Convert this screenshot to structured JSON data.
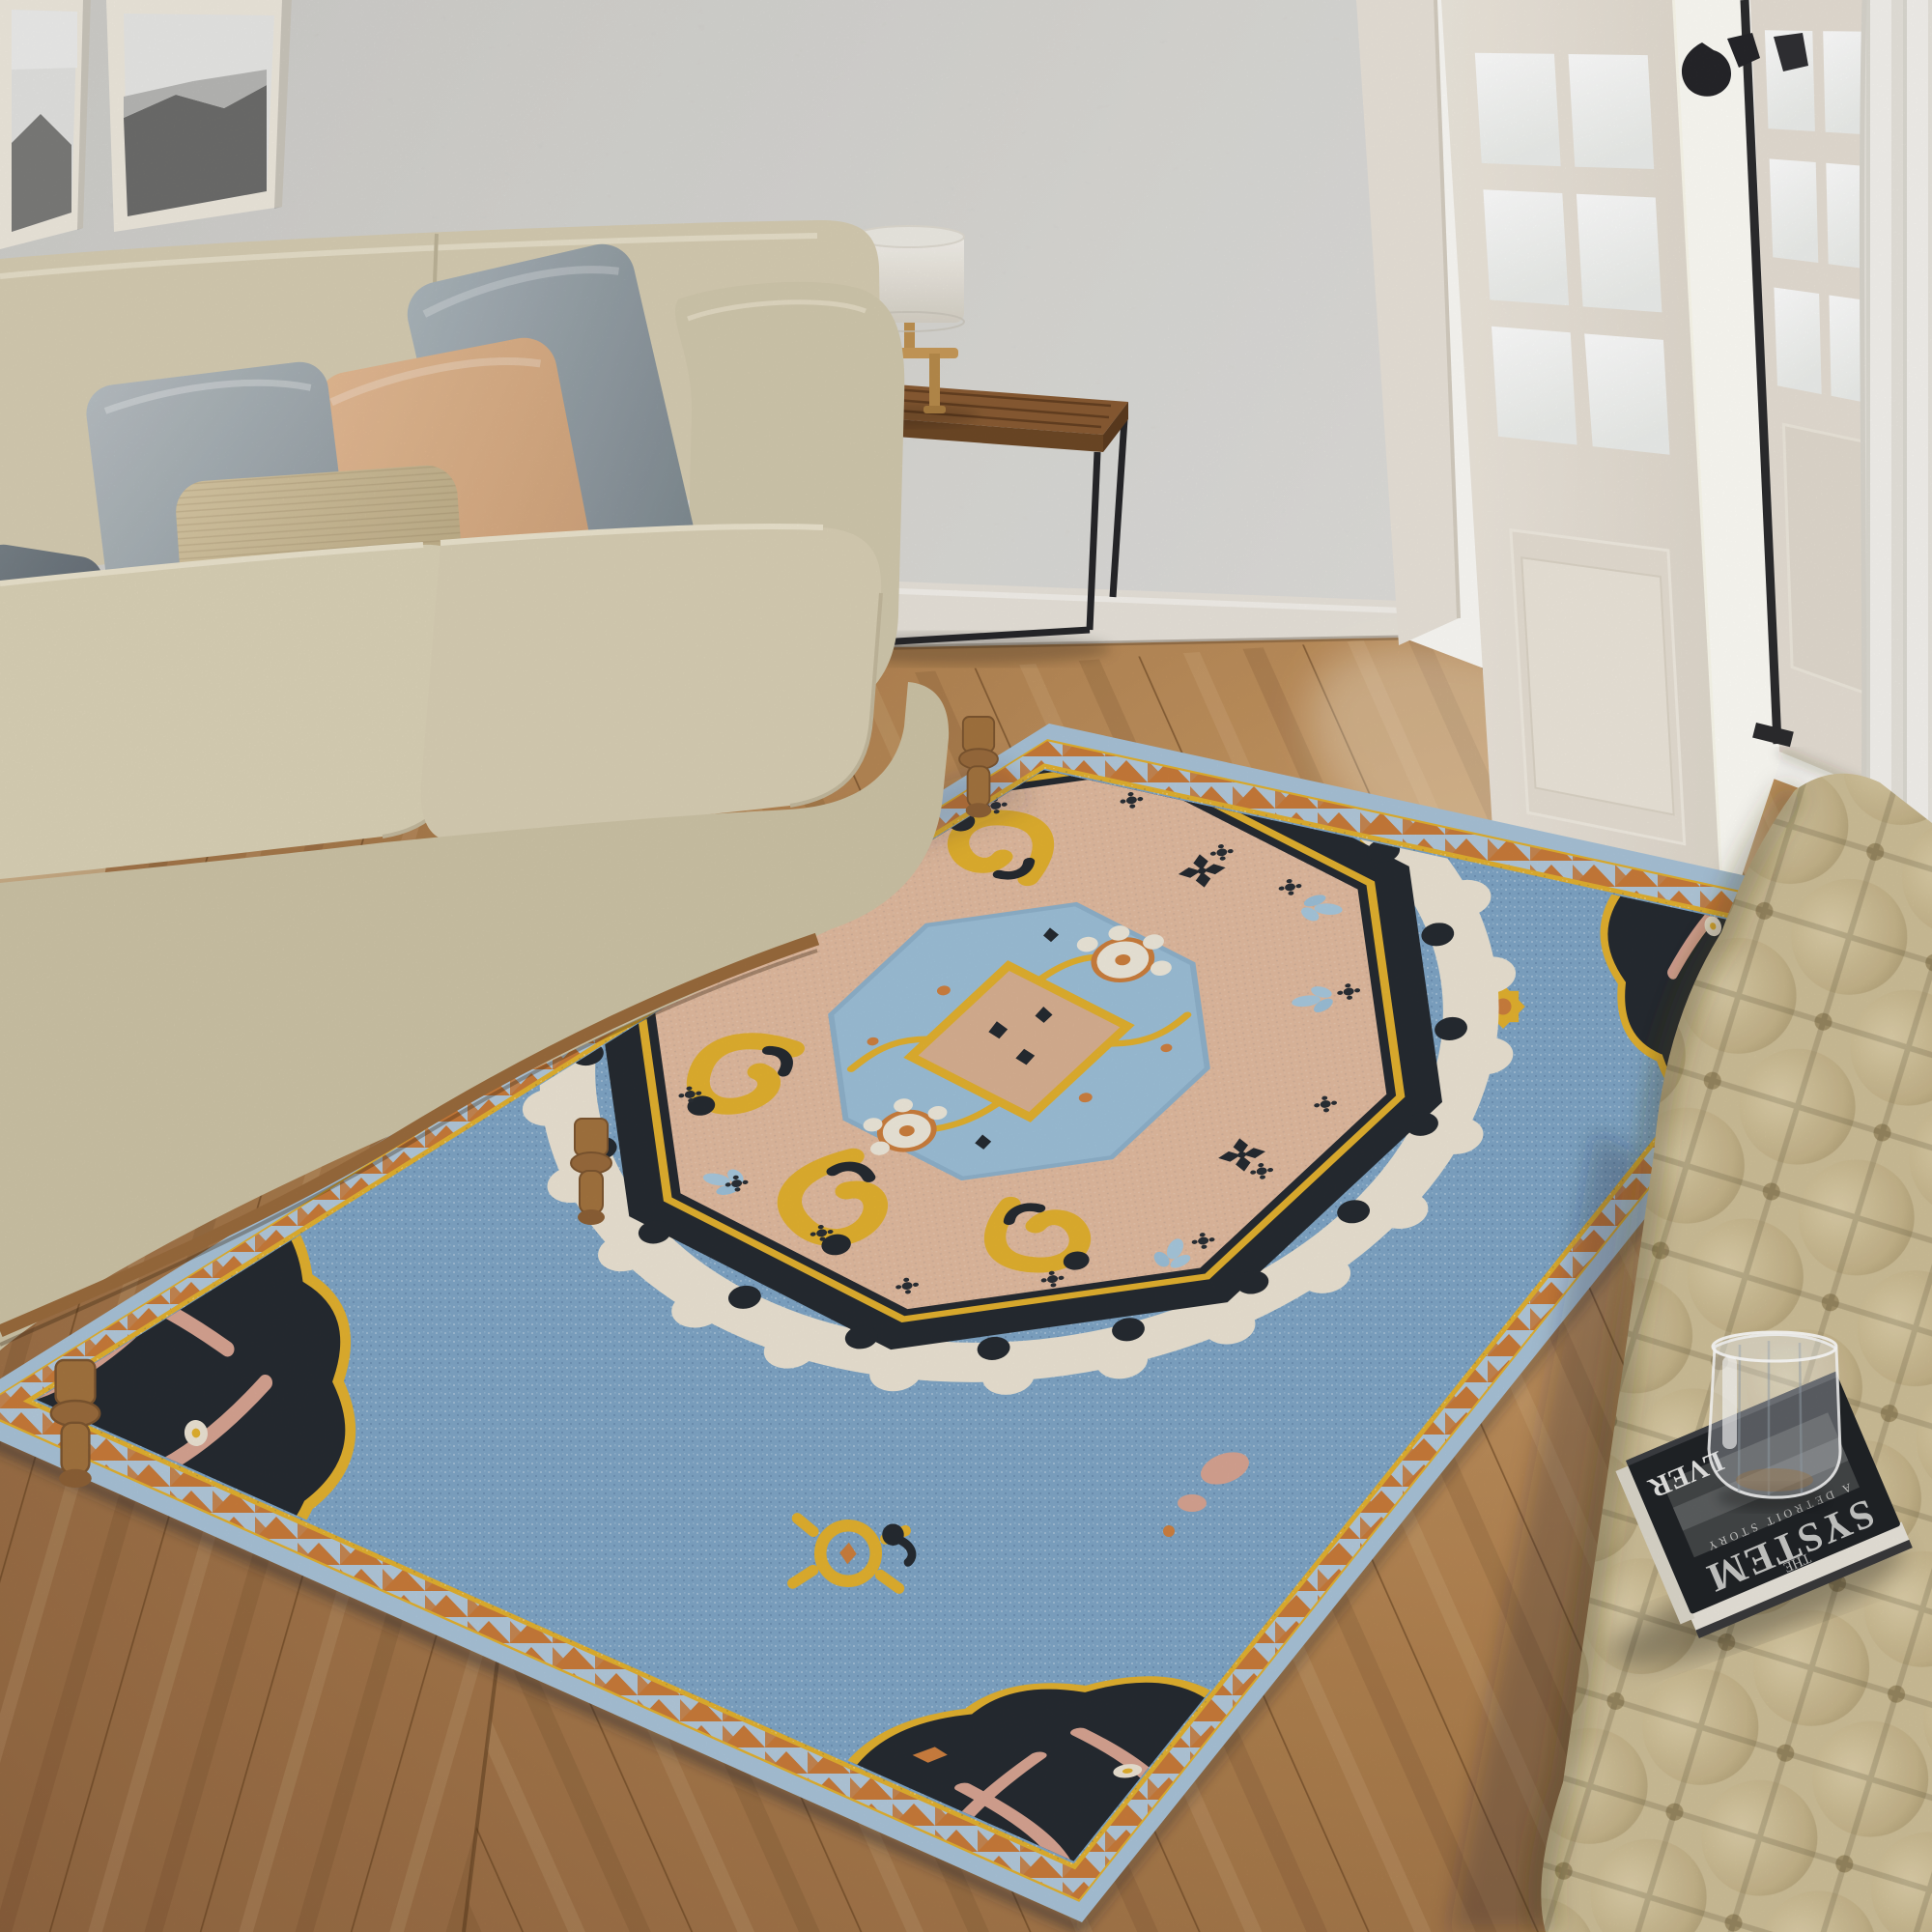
{
  "scene": {
    "description": "3D interior render: living room with cream sofa, blue oriental medallion rug, wood chevron floor, open french doors, tufted ottoman, book with glass tumbler",
    "book": {
      "pretitle": "THE",
      "title": "SYSTEM",
      "subtitle": "A DETROIT STORY",
      "edge_text": "LVER"
    },
    "palette": {
      "wall": "#cdccc8",
      "baseboard": "#e9e4db",
      "floor_wood": "#b07c4f",
      "floor_seam": "#7d572f",
      "sofa": "#d7ceb3",
      "sofa_rail_wood": "#9a6b3d",
      "pillow_light_gray": "#aab3b8",
      "pillow_dark_gray": "#6e777d",
      "pillow_khaki": "#cdbb97",
      "pillow_peach": "#dcb28c",
      "pillow_tan": "#d3b794",
      "rug_field_blue": "#7fa6c6",
      "rug_binding_blue": "#a9c3d8",
      "rug_orange": "#c97b3a",
      "rug_yellow": "#e3b12f",
      "rug_black": "#262b31",
      "rug_ivory": "#ece4d4",
      "rug_peach": "#e2bb9f",
      "rug_motif_blue": "#9dc0d8",
      "rug_pink": "#d8a493",
      "door": "#ece6dc",
      "curtain": "#f4f1ec",
      "ottoman": "#cfbf98",
      "table_wood": "#8a5c33",
      "lamp_wood": "#c89b59",
      "metal_black": "#2a2a2c",
      "book_cover": "#202327",
      "book_pages": "#e9e5db"
    }
  }
}
